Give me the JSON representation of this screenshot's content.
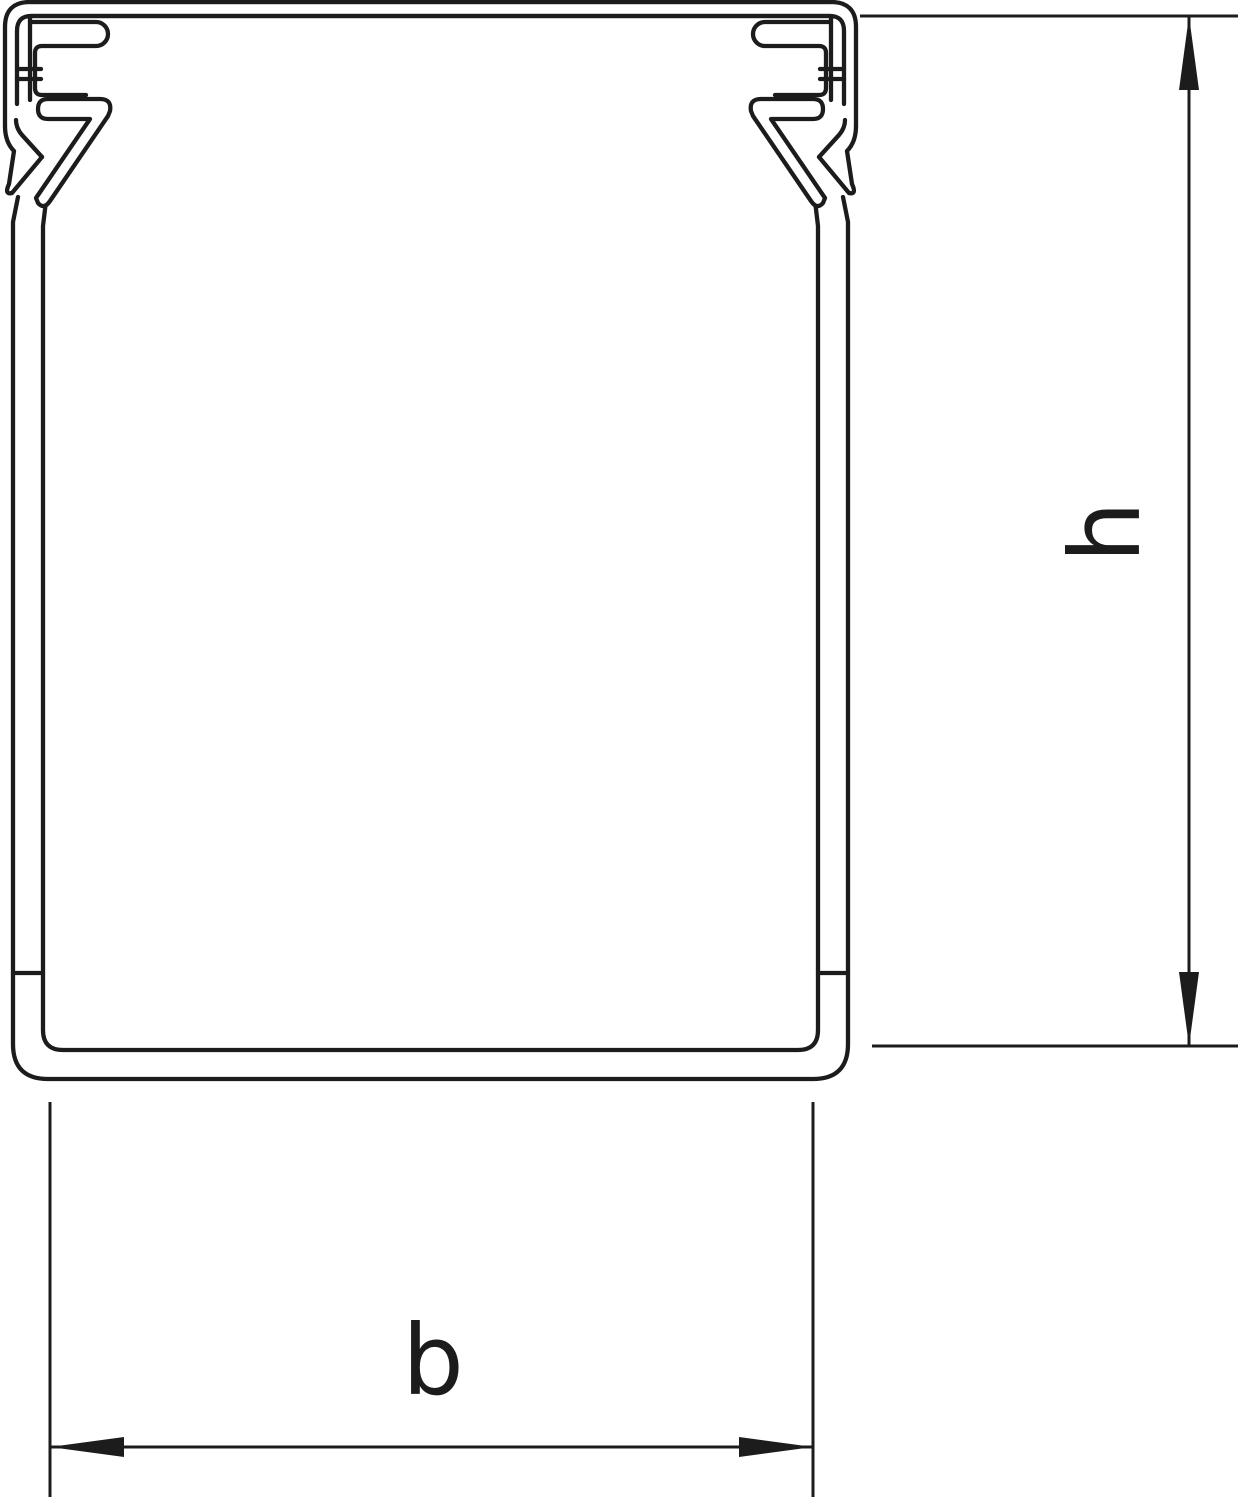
{
  "drawing": {
    "dimension_labels": {
      "height": "h",
      "width": "b"
    },
    "colors": {
      "line": "#1c1c1c",
      "background": "#ffffff"
    }
  }
}
